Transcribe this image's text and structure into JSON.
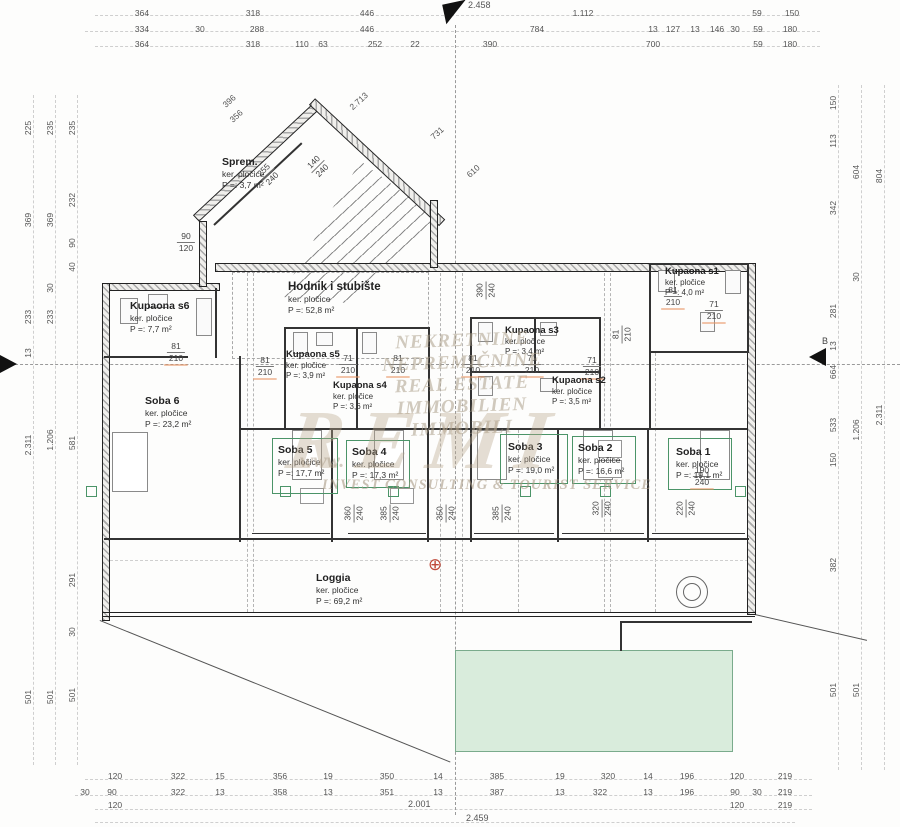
{
  "rooms": [
    {
      "name": "Sprem.",
      "material": "ker. pločice",
      "area": "P =: 3,7 m²"
    },
    {
      "name": "Hodnik i stubište",
      "material": "ker. pločice",
      "area": "P =: 52,8 m²"
    },
    {
      "name": "Kupaona s6",
      "material": "ker. pločice",
      "area": "P =: 7,7 m²"
    },
    {
      "name": "Kupaona s5",
      "material": "ker. pločice",
      "area": "P =: 3,9 m²"
    },
    {
      "name": "Kupaona s4",
      "material": "ker. pločice",
      "area": "P =: 3,6 m²"
    },
    {
      "name": "Kupaona s3",
      "material": "ker. pločice",
      "area": "P =: 3,4 m²"
    },
    {
      "name": "Kupaona s2",
      "material": "ker. pločice",
      "area": "P =: 3,5 m²"
    },
    {
      "name": "Kupaona s1",
      "material": "ker. pločice",
      "area": "P =: 4,0 m²"
    },
    {
      "name": "Soba 6",
      "material": "ker. pločice",
      "area": "P =: 23,2 m²"
    },
    {
      "name": "Soba 5",
      "material": "ker. pločice",
      "area": "P =: 17,7 m²"
    },
    {
      "name": "Soba 4",
      "material": "ker. pločice",
      "area": "P =: 17,3 m²"
    },
    {
      "name": "Soba 3",
      "material": "ker. pločice",
      "area": "P =: 19,0 m²"
    },
    {
      "name": "Soba 2",
      "material": "ker. pločice",
      "area": "P =: 16,6 m²"
    },
    {
      "name": "Soba 1",
      "material": "ker. pločice",
      "area": "P =: 19,1 m²"
    },
    {
      "name": "Loggia",
      "material": "ker. pločice",
      "area": "P =: 69,2 m²"
    },
    {
      "name": "Zeleni krov",
      "material": "",
      "area": "P =: 29,8 m²"
    }
  ],
  "dims": {
    "top1": [
      "364",
      "318",
      "446",
      "1.112",
      "59",
      "150"
    ],
    "top2": [
      "334",
      "30",
      "288",
      "446",
      "784",
      "13",
      "127",
      "13",
      "146",
      "30",
      "59",
      "180"
    ],
    "top3": [
      "364",
      "318",
      "110",
      "63",
      "252",
      "22",
      "390",
      "700",
      "59",
      "180"
    ],
    "bottom1": [
      "120",
      "322",
      "15",
      "356",
      "19",
      "350",
      "14",
      "385",
      "19",
      "320",
      "14",
      "196",
      "120",
      "219"
    ],
    "bottom2": [
      "30",
      "90",
      "322",
      "13",
      "358",
      "13",
      "351",
      "13",
      "387",
      "13",
      "322",
      "13",
      "196",
      "90",
      "30",
      "219"
    ],
    "bottom3": [
      "120",
      "120",
      "219"
    ],
    "left1": [
      "225",
      "369",
      "233",
      "13",
      "2.311",
      "501"
    ],
    "left2": [
      "235",
      "369",
      "30",
      "233",
      "1.206",
      "501"
    ],
    "left3": [
      "235",
      "232",
      "90",
      "40",
      "581",
      "291",
      "30",
      "501"
    ],
    "right1": [
      "150",
      "113",
      "342",
      "281",
      "13",
      "664",
      "533",
      "150",
      "382",
      "501"
    ],
    "right2": [
      "604",
      "30",
      "1.206",
      "501"
    ],
    "right3": [
      "804",
      "2.311"
    ],
    "diagonal": [
      "396",
      "356",
      "2.713",
      "731",
      "610"
    ]
  },
  "pairs": [
    {
      "a": "81",
      "b": "210"
    },
    {
      "a": "81",
      "b": "210"
    },
    {
      "a": "71",
      "b": "210"
    },
    {
      "a": "81",
      "b": "210"
    },
    {
      "a": "81",
      "b": "210"
    },
    {
      "a": "71",
      "b": "210"
    },
    {
      "a": "71",
      "b": "210"
    },
    {
      "a": "81",
      "b": "210"
    },
    {
      "a": "71",
      "b": "210"
    },
    {
      "a": "81",
      "b": "210"
    },
    {
      "a": "90",
      "b": "120"
    },
    {
      "a": "190",
      "b": "240"
    },
    {
      "a": "360",
      "b": "240"
    },
    {
      "a": "385",
      "b": "240"
    },
    {
      "a": "350",
      "b": "240"
    },
    {
      "a": "385",
      "b": "240"
    },
    {
      "a": "320",
      "b": "240"
    },
    {
      "a": "220",
      "b": "240"
    },
    {
      "a": "255",
      "b": "240"
    },
    {
      "a": "140",
      "b": "240"
    },
    {
      "a": "390",
      "b": "240"
    }
  ],
  "watermark": {
    "lines": [
      "NEKRETNINE",
      "NEPREMIČNINE",
      "REAL ESTATE",
      "IMMOBILIEN",
      "IMMOBILI"
    ],
    "prefix": "www.",
    "brand": "REMI",
    "tagline": "INVEST CONSULTING & TOURIST SERVICE"
  },
  "markers": {
    "section_right": "B",
    "top_total": "2.458",
    "bottom_subtotal": "2.001",
    "bottom_total": "2.459",
    "cross": "⊕"
  },
  "colors": {
    "line": "#333333",
    "dim_text": "#555555",
    "accent_green": "#4b9468",
    "green_fill": "#d9ecdc",
    "orange_mark": "#e99664",
    "watermark": "#ac9e89"
  }
}
